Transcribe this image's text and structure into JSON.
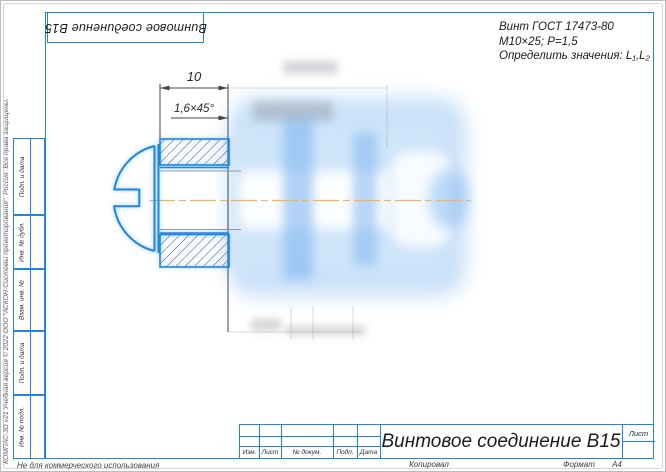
{
  "stamp": {
    "rotated_title": "Винтовое соединение В15"
  },
  "task_note": {
    "line1": "Винт ГОСТ 17473-80",
    "line2": "М10×25;  Р=1,5",
    "line3": "Определить значения: L₁,L₂"
  },
  "drawing": {
    "dim_length": "10",
    "dim_chamfer": "1,6×45°",
    "part": "Винт с полукруглой головкой в соединении, шлиц головки слева, две пластины в разрезе"
  },
  "side_columns": [
    "Подп. и дата",
    "Инв. № дубл.",
    "Взам. инв. №",
    "Подп. и дата",
    "Инв. № подл."
  ],
  "title_block": {
    "title": "Винтовое соединение В15",
    "columns": [
      "Изм.",
      "Лист",
      "№ докум.",
      "Подп.",
      "Дата"
    ],
    "sheet_label": "Лист",
    "kopiroval": "Копировал",
    "format_label": "Формат",
    "format_value": "А4"
  },
  "watermarks": {
    "left_vertical": "КОМПАС-3D v21 Учебная версия © 2022 ООО \"АСКОН-Системы проектирования\", Россия. Все права защищены.",
    "bottom": "Не для коммерческого использования"
  },
  "colors": {
    "frame_blue": "#1d86e3",
    "selection_blue": "#2b93f5",
    "centerline_orange": "#eeb468",
    "hatch": "#4e5a66",
    "dimension": "#444444"
  }
}
